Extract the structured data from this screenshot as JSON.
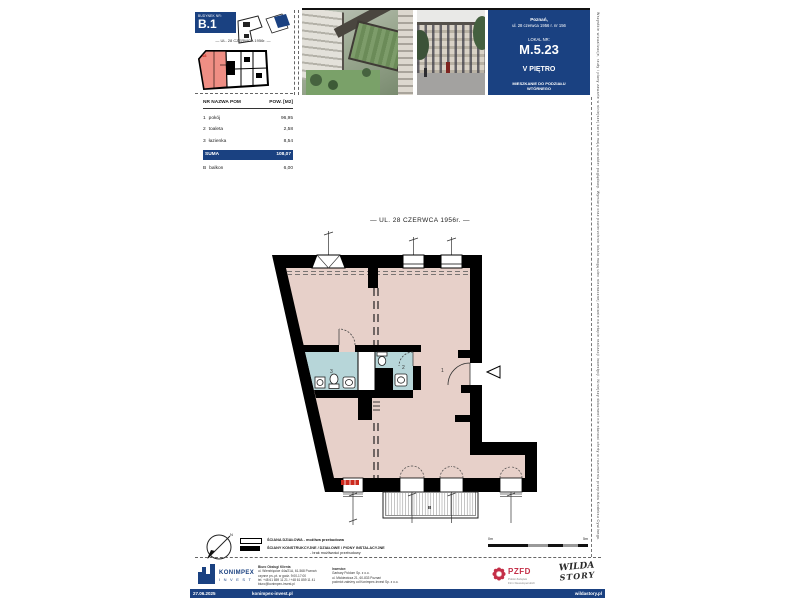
{
  "header": {
    "budynek_label": "BUDYNEK NR:",
    "budynek_no": "B.1",
    "mini_street": "— UL. 28 CZERWCA 1956r. —",
    "mini_unit": "18"
  },
  "panel": {
    "city": "Poznań,",
    "address": "ul. 28 czerwca 1956 r. nr 156",
    "lokal_label": "LOKAL NR:",
    "lokal_no": "M.5.23",
    "floor": "V PIĘTRO",
    "note1": "MIESZKANIE DO PODZIAŁU",
    "note2": "WTÓRNEGO"
  },
  "table": {
    "col_left": "NR  NAZWA POM",
    "col_right": "POW. [M2]",
    "rows": [
      {
        "no": "1",
        "name": "pokój",
        "area": "96,95"
      },
      {
        "no": "2",
        "name": "toaleta",
        "area": "2,58"
      },
      {
        "no": "3",
        "name": "łazienka",
        "area": "8,54"
      }
    ],
    "suma_label": "SUMA",
    "suma_area": "108,07",
    "extra": {
      "no": "B",
      "name": "balkon",
      "area": "6,00"
    }
  },
  "plan": {
    "title": "— UL. 28 CZERWCA 1956r. —",
    "labels": {
      "r1": "1",
      "r2": "2",
      "r3": "3",
      "balcony": "B"
    },
    "colors": {
      "room_fill": "#e7d0c9",
      "wet_fill": "#b7d6d9",
      "wall": "#000000",
      "accent_red": "#cc2a1e",
      "brand_blue": "#1a4181",
      "mini_unit_red": "#ef8e84"
    }
  },
  "legend": {
    "l1": "ŚCIANA DZIAŁOWA - możliwa przebudowa",
    "l2": "ŚCIANY KONSTRUKCYJNE / DZIAŁOWE / PIONY INSTALACYJNE",
    "l3": "- brak możliwości przebudowy"
  },
  "scale": {
    "left": "0m",
    "right": "5m"
  },
  "compass": {
    "n": "N"
  },
  "logos": {
    "konimpex_name": "KONIMPEX",
    "konimpex_sub": "I N V E S T",
    "pzfd_name": "PZFD",
    "pzfd_sub1": "Polski Związek",
    "pzfd_sub2": "Firm Deweloperskich",
    "wilda_l1": "WILDA",
    "wilda_l2": "STORY"
  },
  "office": {
    "l1": "Biuro Obsługi Klienta",
    "l2": "ul. Wierzbięcice 44a/21A, 61-568 Poznań",
    "l3": "czynne pn.-pt. w godz. 9:00-17:00",
    "l4": "tel. +48 61 859 11 21 / +48 61 859 11 41",
    "l5": "biuro@konimpex-invest.pl"
  },
  "investor": {
    "l1": "Inwestor:",
    "l2": "Garbary Poldom Sp. z o.o.",
    "l3": "ul. Mickiewicza 21, 60-833 Poznań",
    "l4": "podmiot zależny od Konimpex-Invest Sp. z o.o."
  },
  "bar": {
    "date": "27.06.2025",
    "site_left": "konimpex-invest.pl",
    "site_right": "wildastory.pl"
  },
  "disclaimer": "Wszystkie wizualizacje, rzuty i plany zawarte w niniejszej karcie mają charakter poglądowy. Wymiary oraz powierzchnie lokalu mogą ulec nieznacznej zmianie na etapie realizacji inwestycji. Niniejszy dokument nie stanowi oferty w rozumieniu przepisów Kodeksu Cywilnego."
}
